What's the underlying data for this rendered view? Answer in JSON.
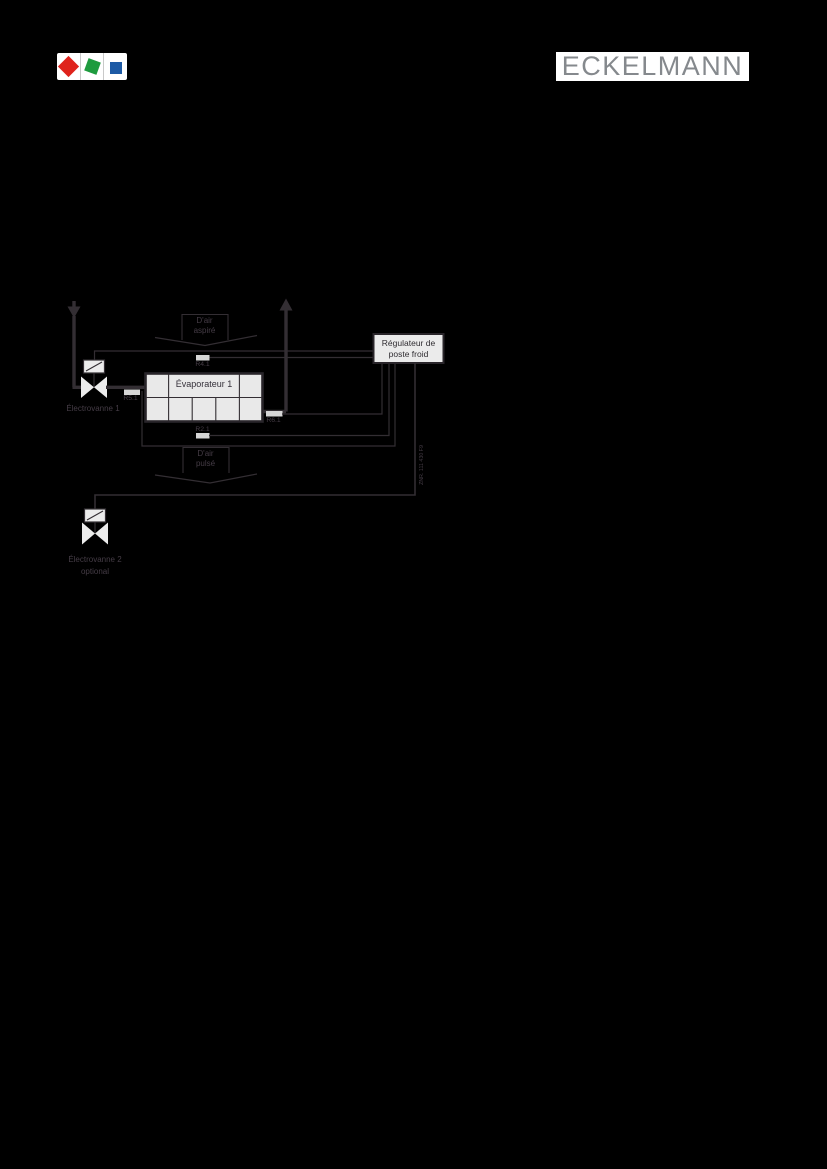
{
  "header": {
    "brand_logo_squares": [
      {
        "name": "red-square",
        "color": "#df231c"
      },
      {
        "name": "green-square",
        "color": "#1e9b3e"
      },
      {
        "name": "blue-square",
        "color": "#1d5aa5"
      }
    ],
    "wordmark": "ECKELMANN",
    "wordmark_color": "#85898d"
  },
  "diagram": {
    "colors": {
      "page_background": "#000000",
      "line": "#332e33",
      "label_text": "#453c46",
      "evaporator_fill": "#e9e9e9",
      "controller_fill": "#ebebeb",
      "sensor_fill": "#d6d6d6",
      "valve_fill": "#ececec"
    },
    "airflow_top": {
      "line1": "D'air",
      "line2": "aspiré"
    },
    "airflow_bottom": {
      "line1": "D'air",
      "line2": "pulsé"
    },
    "controller": {
      "line1": "Régulateur de",
      "line2": "poste froid"
    },
    "evaporator": {
      "label": "Évaporateur 1"
    },
    "sensors": {
      "r41": "R4.1",
      "r51": "R5.1",
      "r61": "R6.1",
      "r21": "R2.1"
    },
    "valve1": {
      "label": "Électrovanne 1"
    },
    "valve2": {
      "line1": "Électrovanne 2",
      "line2": "optional"
    },
    "drawing_number": "ZNR. 111 430 F9"
  }
}
